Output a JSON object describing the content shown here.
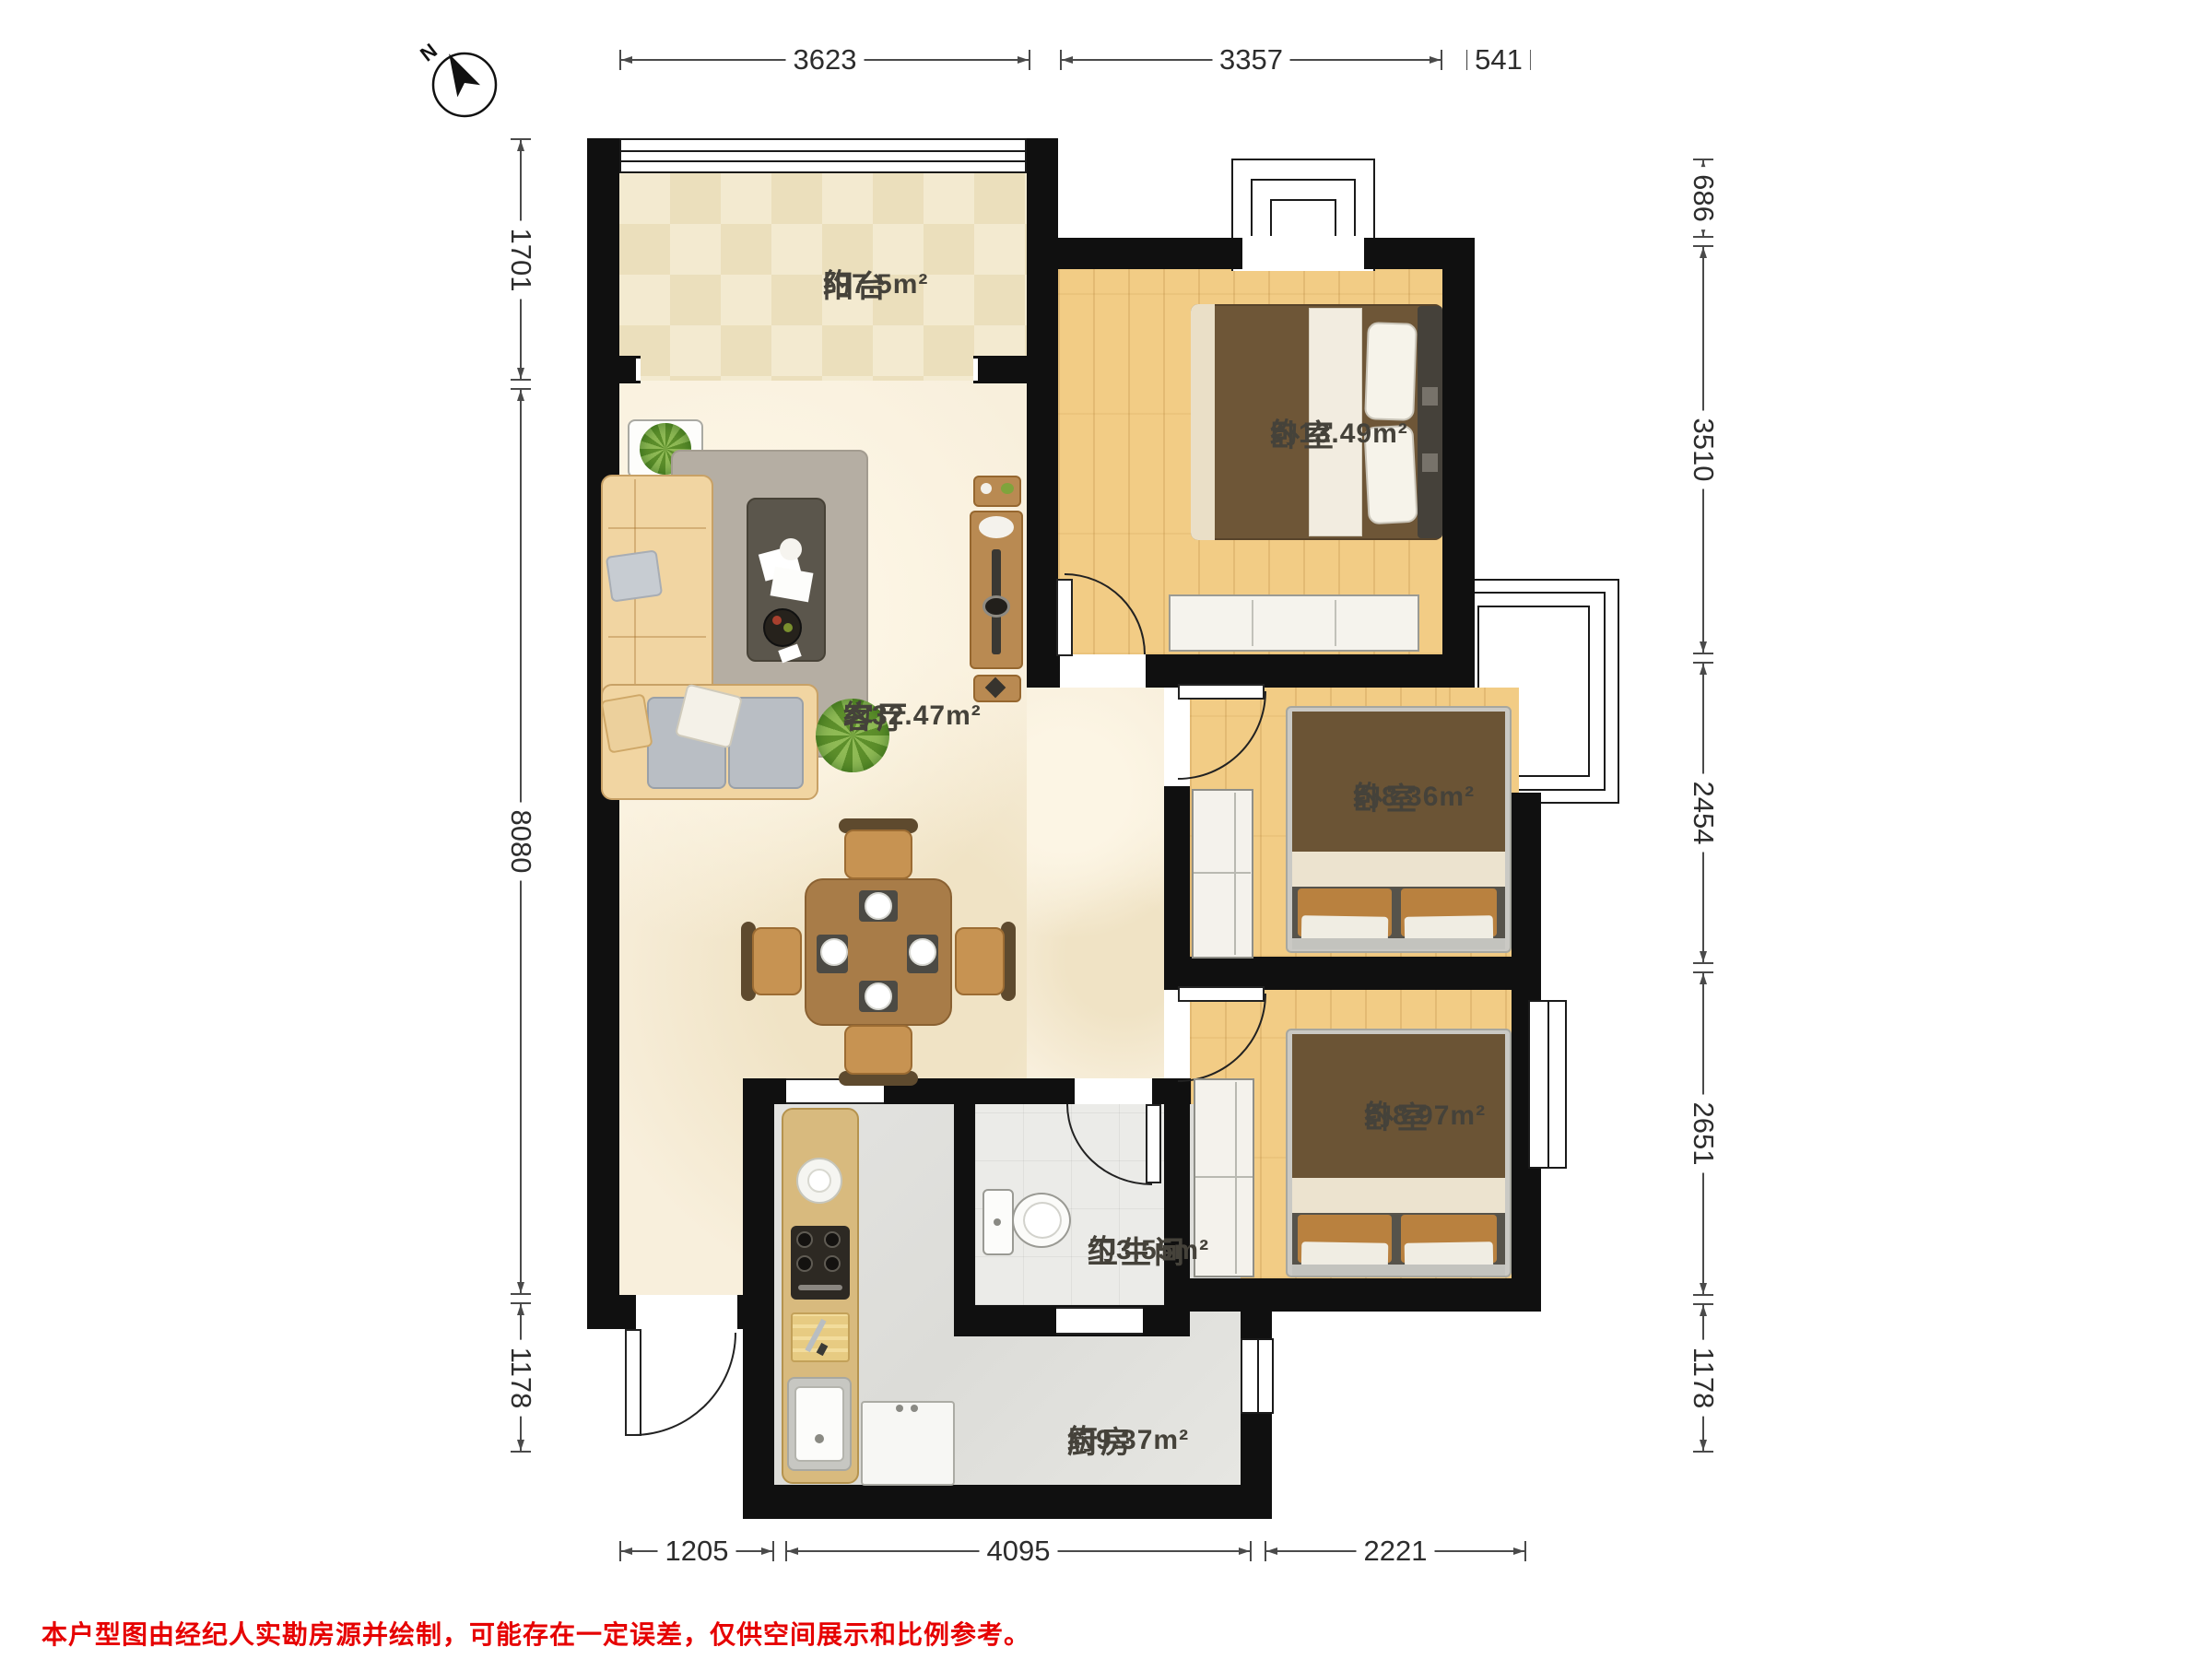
{
  "compass": {
    "label": "N"
  },
  "rooms": [
    {
      "id": "balcony",
      "name": "阳台",
      "area": "约7.5m²"
    },
    {
      "id": "living",
      "name": "客厅",
      "area": "约32.47m²"
    },
    {
      "id": "bedroom1",
      "name": "卧室",
      "area": "约13.49m²"
    },
    {
      "id": "bedroom2",
      "name": "卧室",
      "area": "约8.36m²"
    },
    {
      "id": "bedroom3",
      "name": "卧室",
      "area": "约8.97m²"
    },
    {
      "id": "bathroom",
      "name": "卫生间",
      "area": "约3.55m²"
    },
    {
      "id": "kitchen",
      "name": "厨房",
      "area": "约9.37m²"
    }
  ],
  "dimensions": {
    "top": [
      "3623",
      "3357",
      "541"
    ],
    "right": [
      "686",
      "3510",
      "2454",
      "2651",
      "1178"
    ],
    "left": [
      "1701",
      "8080",
      "1178"
    ],
    "bottom": [
      "1205",
      "4095",
      "2221"
    ]
  },
  "disclaimer": "本户型图由经纪人实勘房源并绘制，可能存在一定误差，仅供空间展示和比例参考。",
  "colors": {
    "wall": "#101010",
    "wood": "#f2cc85",
    "marble": "#f8efdc",
    "tile_a": "#f3ead0",
    "tile_b": "#ebdfbc",
    "gray_floor": "#e0dfdc",
    "bath_floor": "#ebebe8",
    "dim_line": "#4a4a4a",
    "label_color": "#45423a",
    "disclaimer_red": "#e60000"
  }
}
